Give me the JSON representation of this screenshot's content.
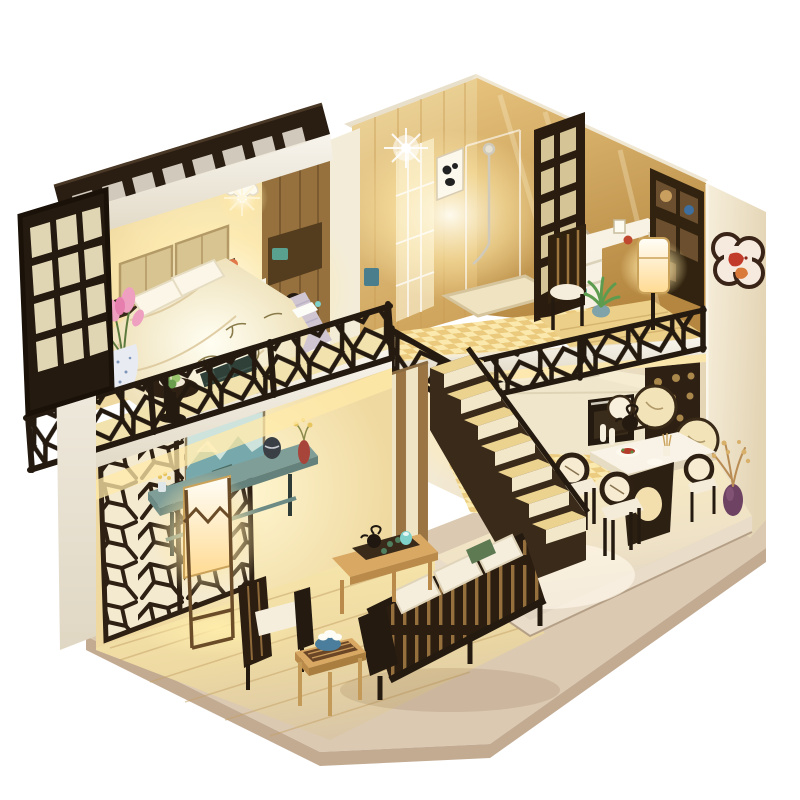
{
  "scene": {
    "title": "Miniature DIY dollhouse diorama",
    "aria_label": "Product photo of a Chinese-style DIY miniature dollhouse loft, interior lit with warm LED lights, on a white background",
    "background": "#ffffff"
  },
  "palette": {
    "bg": "#ffffff",
    "wall_white": "#f4f0e5",
    "wall_white_shade": "#ddd4c1",
    "wall_cream": "#f1e6c8",
    "wall_warm": "#f7e9bd",
    "gold_light": "#ecd397",
    "gold_deep": "#c0924c",
    "wood_floor": "#ecd089",
    "wood_floor_bright": "#f7e7ac",
    "wood_light": "#d9a964",
    "wood_mid": "#a97e3f",
    "wood_dark": "#4a3320",
    "wood_darker": "#281c10",
    "glow_warm": "#ffe9a8",
    "glow_bright": "#fffdf2",
    "checker_light": "#f8ecb8",
    "checker_dark": "#e3c276",
    "base_pale": "#dbc9b2",
    "base_edge": "#c3ab92",
    "platform_light": "#efe5d6",
    "teal": "#4a7e8c",
    "teal_deep": "#2e4038",
    "sage_console": "#7f9e98",
    "pink_blossom": "#ef9fc0",
    "green_leaf": "#6faf5e",
    "green_dark": "#47773d",
    "navy_quilt": "#3c4f66",
    "lilac_blanket": "#cfc6d2",
    "purple_vase": "#7b4a6e",
    "red_accent": "#c23b2a",
    "cushion_ivory": "#f5eedc",
    "painting_sky": "#cfe3dd",
    "painting_teal": "#76a8ac",
    "silver": "#cfcabb"
  },
  "rooms": {
    "loft_bedroom": {
      "name": "Loft bedroom",
      "items": [
        "pergola slat roof",
        "carved window shutter",
        "lace pendant lamp",
        "double bed with floral duvet",
        "quilted headboard",
        "pillows",
        "lilac blanket",
        "quilted teal storage bench",
        "wardrobe with cat door",
        "white nightstand",
        "pink blossoms in speckled vase",
        "pedestal table with lime plate",
        "fretwork balcony railing"
      ]
    },
    "bathroom": {
      "name": "Bathroom",
      "items": [
        "golden wood walls",
        "glass shower cabin",
        "chrome shower set",
        "panda wall art",
        "checkerboard tile floor",
        "white vanity shelf with towels",
        "round mirror",
        "laundry bin",
        "lattice partition screen"
      ]
    },
    "study": {
      "name": "Study corner",
      "items": [
        "mirror-gold wall",
        "white writing desk",
        "slatted wooden chair",
        "display bookshelf",
        "glowing paper floor lamp",
        "potted plant",
        "photo frame"
      ]
    },
    "kitchen": {
      "name": "Kitchen",
      "items": [
        "cream cabinets",
        "gas hob with frying pan",
        "built-in oven",
        "inset sink",
        "checkerboard tile floor"
      ]
    },
    "dining_room": {
      "name": "Dining room",
      "items": [
        "white dining table with carved base",
        "three round-back chairs",
        "meal plates",
        "incense cup",
        "round fan wall plaques",
        "carved fretwork wall panel",
        "iron teapot on shelf",
        "white bottle vases",
        "purple vase with gilded branches",
        "glossy platform floor"
      ]
    },
    "living_room": {
      "name": "Living room",
      "items": [
        "ice-ray lattice screen wall",
        "landscape painting",
        "teal console table",
        "dark jar",
        "red bud vase",
        "glowing column floor lamp",
        "slatted sofa with ivory cushions",
        "green accent pillow",
        "slatted armchair",
        "coffee table with tea tray",
        "side table with blue bowl and lotus",
        "plank wood floor"
      ]
    },
    "structure": {
      "name": "House structure",
      "items": [
        "white loft walls",
        "staircase with seven treads",
        "striped under-stair paneling",
        "x-braced stair railing",
        "warm led lighting",
        "cream exterior wall",
        "koi quatrefoil plaque",
        "clear acrylic roof edge",
        "pale wood display base"
      ]
    }
  }
}
